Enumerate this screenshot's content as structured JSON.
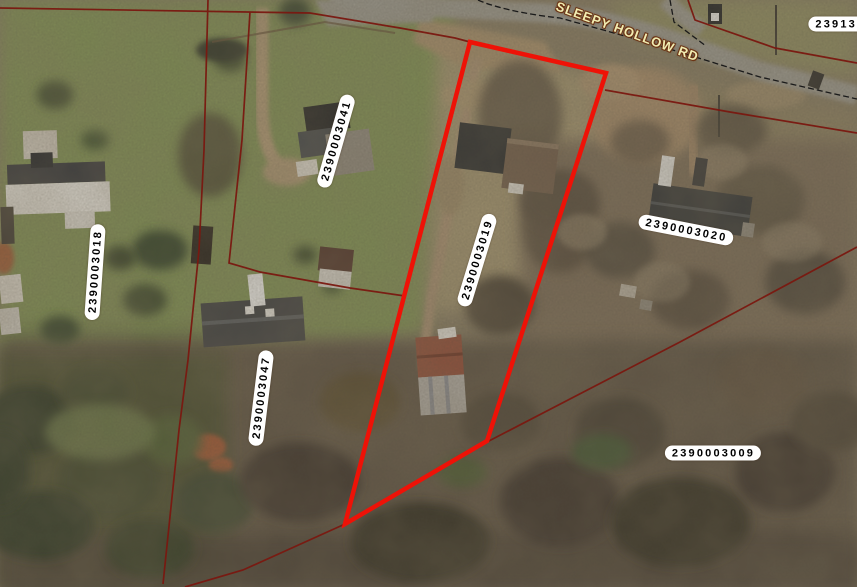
{
  "map": {
    "road_label": "SLEEPY HOLLOW RD",
    "edge_parcel_label": "2391301",
    "selected_parcel_id": "2390003019",
    "parcel_labels": {
      "p2390003041": "2390003041",
      "p2390003018": "2390003018",
      "p2390003019": "2390003019",
      "p2390003047": "2390003047",
      "p2390003020": "2390003020",
      "p2390003009": "2390003009"
    },
    "colors": {
      "selected_outline": "#ee1207",
      "parcel_line": "#7a1810",
      "road_dashed_line": "#1a1a1a",
      "road_label_fill": "#f1ecb2",
      "label_bg": "#ffffff",
      "label_text": "#000000"
    }
  }
}
